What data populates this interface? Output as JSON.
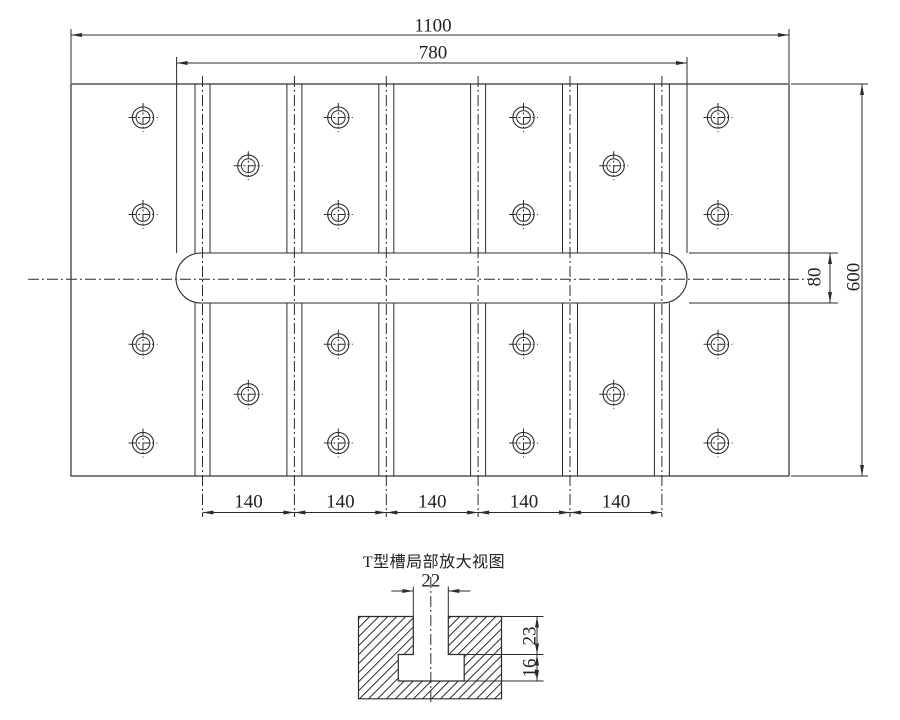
{
  "drawing": {
    "background": "#ffffff",
    "line_color": "#2b2b2b",
    "main_view": {
      "dims": {
        "total_width": "1100",
        "slot_region_width": "780",
        "total_height": "600",
        "center_slot_width": "80",
        "tslot_pitch": [
          "140",
          "140",
          "140",
          "140",
          "140"
        ]
      },
      "plate": {
        "x": 71,
        "y": 84,
        "w": 718,
        "h": 392
      },
      "center_slot": {
        "x": 176,
        "y": 253,
        "w": 511,
        "h": 50,
        "r": 25
      },
      "h_centerline": {
        "y": 279.3,
        "x1": 28,
        "x2": 810
      },
      "tslots": {
        "centers": [
          202.5,
          294.4,
          386.3,
          478.1,
          570,
          661.9
        ],
        "half_width": 7.5,
        "top_ext": 76,
        "bottom_ext": 517
      },
      "holes": {
        "outer_r": 10.6,
        "inner_r": 6.9,
        "cross_r": 14.5,
        "centers": [
          [
            143,
            117.5
          ],
          [
            338.3,
            117.5
          ],
          [
            523.5,
            117.5
          ],
          [
            718,
            117.5
          ],
          [
            248.3,
            165.7
          ],
          [
            613.7,
            165.7
          ],
          [
            143,
            214.5
          ],
          [
            338.3,
            214.5
          ],
          [
            523.5,
            214.5
          ],
          [
            718,
            214.5
          ],
          [
            143,
            344.3
          ],
          [
            338.3,
            344.3
          ],
          [
            523.5,
            344.3
          ],
          [
            718,
            344.3
          ],
          [
            248.3,
            394.3
          ],
          [
            613.7,
            394.3
          ],
          [
            143,
            443
          ],
          [
            338.3,
            443
          ],
          [
            523.5,
            443
          ],
          [
            718,
            443
          ]
        ]
      },
      "dim_total_width_geom": {
        "y": 35,
        "x1": 71,
        "x2": 789,
        "ext_top": 29,
        "ext_bottom": 83
      },
      "dim_slot_region_geom": {
        "y": 63,
        "x1": 176.6,
        "x2": 687,
        "ext_top": 57,
        "ext_bottom": 253
      },
      "dim_height_geom": {
        "x": 862,
        "y1": 84,
        "y2": 476,
        "ext_x1": 791,
        "ext_x2": 868
      },
      "dim_slot_width_geom": {
        "x": 830,
        "y1": 253,
        "y2": 303,
        "ext_x1": 689,
        "ext_x2": 838
      },
      "dim_pitch_geom": {
        "y": 512.5,
        "bounds": [
          202.5,
          294.4,
          386.3,
          478.1,
          570,
          661.9
        ]
      }
    },
    "detail_view": {
      "title": "T型槽局部放大视图",
      "dims": {
        "slot_top_width": "22",
        "slot_top_depth": "23",
        "slot_foot_height": "16"
      },
      "block": {
        "left": 358.5,
        "top": 616.5,
        "right": 501.5,
        "bottom": 698.8,
        "narrow_x1": 413.3,
        "narrow_x2": 448.3,
        "shoulder_y": 654.5,
        "wide_x1": 398.3,
        "wide_x2": 464.2,
        "wide_bottom": 681,
        "hatch_spacing": 9
      },
      "centerline": {
        "x": 430.8,
        "y1": 577,
        "y2": 702
      },
      "dim22_geom": {
        "y": 591,
        "x1": 413.3,
        "x2": 448.3,
        "tail": 22,
        "ext_top": 586.5
      },
      "dim23_geom": {
        "x": 537,
        "y1": 616.5,
        "y2": 654.5,
        "ext1_x1": 501.5,
        "ext2_x1": 464.2,
        "ext_x2": 543.5
      },
      "dim16_geom": {
        "x": 537,
        "y1": 654.5,
        "y2": 681,
        "ext_x1": 464.2,
        "ext_x2": 543.5
      }
    }
  },
  "labels": [
    {
      "name": "dim-label-total-width",
      "text": "1100",
      "x": 433,
      "y": 26,
      "rot": 0
    },
    {
      "name": "dim-label-slot-region-width",
      "text": "780",
      "x": 433,
      "y": 53,
      "rot": 0
    },
    {
      "name": "dim-label-total-height",
      "text": "600",
      "x": 854,
      "y": 277,
      "rot": -90
    },
    {
      "name": "dim-label-center-slot-width",
      "text": "80",
      "x": 815,
      "y": 277,
      "rot": -90
    },
    {
      "name": "dim-label-pitch-1",
      "text": "140",
      "x": 248.5,
      "y": 501.5,
      "rot": 0
    },
    {
      "name": "dim-label-pitch-2",
      "text": "140",
      "x": 340.4,
      "y": 501.5,
      "rot": 0
    },
    {
      "name": "dim-label-pitch-3",
      "text": "140",
      "x": 432.2,
      "y": 501.5,
      "rot": 0
    },
    {
      "name": "dim-label-pitch-4",
      "text": "140",
      "x": 524,
      "y": 501.5,
      "rot": 0
    },
    {
      "name": "dim-label-pitch-5",
      "text": "140",
      "x": 616,
      "y": 501.5,
      "rot": 0
    },
    {
      "name": "detail-view-title",
      "text": "T型槽局部放大视图",
      "x": 434,
      "y": 563,
      "rot": 0,
      "cls": "title"
    },
    {
      "name": "dim-label-detail-slot-width",
      "text": "22",
      "x": 430.7,
      "y": 581,
      "rot": 0
    },
    {
      "name": "dim-label-detail-slot-depth",
      "text": "23",
      "x": 530,
      "y": 635.5,
      "rot": -90
    },
    {
      "name": "dim-label-detail-foot-height",
      "text": "16",
      "x": 530,
      "y": 667.5,
      "rot": -90
    }
  ]
}
